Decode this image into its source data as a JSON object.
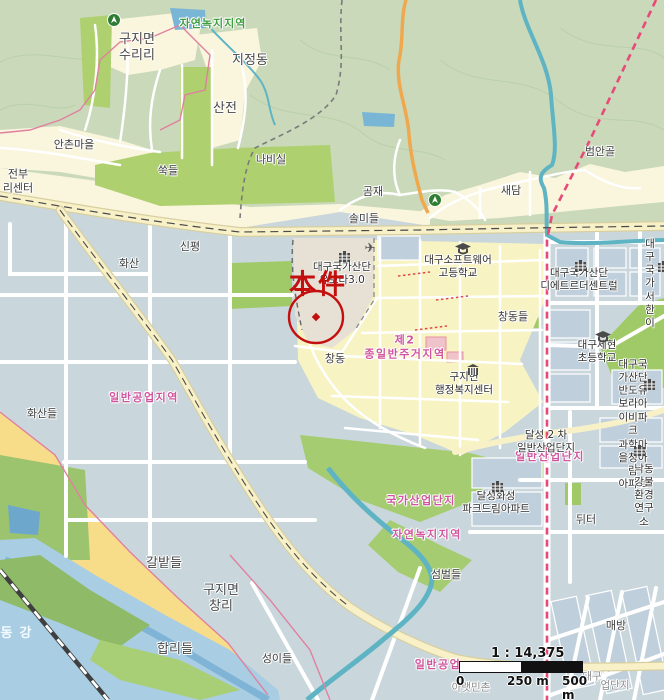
{
  "map": {
    "annotation": {
      "text": "本件",
      "x": 318,
      "y": 282,
      "color": "#c40f0f"
    },
    "scale": {
      "ratio": "1 : 14,375",
      "start": "0",
      "mid": "250 m",
      "end": "500 m"
    },
    "colors": {
      "forest": "#c9d9b9",
      "field-green": "#aed06e",
      "village-cream": "#faf5dd",
      "industrial-gray": "#c9d7dc",
      "residential-yellow": "#f7f3c2",
      "farm-yellow": "#f7dc8a",
      "subject-tan": "#e7e0d4",
      "water": "#a9cde3",
      "stream": "#5fb4c4",
      "major-road": "#f8f1c8",
      "orange-road": "#f0a84e",
      "boundary-red": "#e84a78",
      "zone-label-pink": "#d0559e",
      "annotation-red": "#c40f0f"
    },
    "labels": [
      {
        "text": "구지면\n수리리",
        "x": 137,
        "y": 48,
        "cls": "place-lg"
      },
      {
        "text": "자연녹지지역",
        "x": 213,
        "y": 24,
        "cls": "zone-green"
      },
      {
        "text": "지정동",
        "x": 250,
        "y": 61,
        "cls": "place-lg"
      },
      {
        "text": "산전",
        "x": 225,
        "y": 109,
        "cls": "place-lg"
      },
      {
        "text": "안촌마을",
        "x": 74,
        "y": 145,
        "cls": "place"
      },
      {
        "text": "쑥들",
        "x": 168,
        "y": 171,
        "cls": "place"
      },
      {
        "text": "나비실",
        "x": 271,
        "y": 160,
        "cls": "place"
      },
      {
        "text": "곰재",
        "x": 373,
        "y": 192,
        "cls": "place"
      },
      {
        "text": "솔미들",
        "x": 364,
        "y": 219,
        "cls": "place"
      },
      {
        "text": "새담",
        "x": 511,
        "y": 191,
        "cls": "place"
      },
      {
        "text": "범안골",
        "x": 600,
        "y": 152,
        "cls": "place"
      },
      {
        "text": "전부\n리센터",
        "x": 18,
        "y": 181,
        "cls": "place"
      },
      {
        "text": "신평",
        "x": 190,
        "y": 247,
        "cls": "place"
      },
      {
        "text": "화산",
        "x": 129,
        "y": 264,
        "cls": "place"
      },
      {
        "text": "화산들",
        "x": 42,
        "y": 414,
        "cls": "place"
      },
      {
        "text": "일반공업지역",
        "x": 144,
        "y": 398,
        "cls": "zone-pink"
      },
      {
        "text": "갈밭들",
        "x": 164,
        "y": 564,
        "cls": "place-lg"
      },
      {
        "text": "구지면\n창리",
        "x": 221,
        "y": 599,
        "cls": "place-lg"
      },
      {
        "text": "합리들",
        "x": 175,
        "y": 650,
        "cls": "place-lg"
      },
      {
        "text": "낙동강",
        "x": 10,
        "y": 634,
        "cls": "white-river"
      },
      {
        "text": "성이들",
        "x": 277,
        "y": 659,
        "cls": "place"
      },
      {
        "text": "매방",
        "x": 616,
        "y": 626,
        "cls": "place"
      },
      {
        "text": "뒤터",
        "x": 586,
        "y": 520,
        "cls": "place"
      },
      {
        "text": "섬벌들",
        "x": 446,
        "y": 575,
        "cls": "place"
      },
      {
        "text": "창동",
        "x": 335,
        "y": 359,
        "cls": "place"
      },
      {
        "text": "창동들",
        "x": 513,
        "y": 317,
        "cls": "place"
      },
      {
        "text": "일반공업",
        "x": 438,
        "y": 665,
        "cls": "zone-pink"
      },
      {
        "text": "국가산업단지",
        "x": 421,
        "y": 501,
        "cls": "zone-pink"
      },
      {
        "text": "자연녹지지역",
        "x": 427,
        "y": 535,
        "cls": "zone-pink"
      },
      {
        "text": "일반산업단지",
        "x": 550,
        "y": 457,
        "cls": "zone-pink"
      },
      {
        "text": "제2\n종일반주거지역",
        "x": 405,
        "y": 347,
        "cls": "zone-pink"
      },
      {
        "text": "대구국가산단\n유보라3.0",
        "x": 342,
        "y": 274,
        "cls": "poi"
      },
      {
        "text": "대구소프트웨어\n고등학교",
        "x": 458,
        "y": 267,
        "cls": "poi"
      },
      {
        "text": "대구국가산단\n디에트르더센트럴",
        "x": 579,
        "y": 280,
        "cls": "poi"
      },
      {
        "text": "대구국가\n서한이",
        "x": 650,
        "y": 284,
        "cls": "poi"
      },
      {
        "text": "대구세현\n초등학교",
        "x": 597,
        "y": 352,
        "cls": "poi"
      },
      {
        "text": "구지면\n행정복지센터",
        "x": 464,
        "y": 384,
        "cls": "poi"
      },
      {
        "text": "대구국가산단\n반도유보라아이비파크",
        "x": 633,
        "y": 398,
        "cls": "poi"
      },
      {
        "text": "달성 2 차\n일반산업단지",
        "x": 546,
        "y": 442,
        "cls": "poi"
      },
      {
        "text": "과학마을청아람\n아파트",
        "x": 633,
        "y": 465,
        "cls": "poi"
      },
      {
        "text": "달성화성\n파크드림아파트",
        "x": 496,
        "y": 503,
        "cls": "poi"
      },
      {
        "text": "낙동강물\n환경연구소",
        "x": 644,
        "y": 496,
        "cls": "poi"
      },
      {
        "text": "아랫민촌",
        "x": 471,
        "y": 688,
        "cls": "gray"
      },
      {
        "text": "대구",
        "x": 592,
        "y": 677,
        "cls": "gray"
      },
      {
        "text": "업단지",
        "x": 615,
        "y": 686,
        "cls": "gray"
      }
    ],
    "icons": [
      {
        "type": "trail-marker-icon",
        "x": 107,
        "y": 13
      },
      {
        "type": "trail-marker-icon",
        "x": 428,
        "y": 193
      },
      {
        "type": "school-icon",
        "x": 455,
        "y": 243
      },
      {
        "type": "school-icon",
        "x": 595,
        "y": 331
      },
      {
        "type": "apartment-icon",
        "x": 338,
        "y": 251
      },
      {
        "type": "apartment-icon",
        "x": 574,
        "y": 260
      },
      {
        "type": "apartment-icon",
        "x": 657,
        "y": 261
      },
      {
        "type": "apartment-icon",
        "x": 643,
        "y": 379
      },
      {
        "type": "apartment-icon",
        "x": 633,
        "y": 445
      },
      {
        "type": "apartment-icon",
        "x": 491,
        "y": 481
      },
      {
        "type": "gov-office-icon",
        "x": 466,
        "y": 364
      },
      {
        "type": "airplane-icon",
        "x": 370,
        "y": 248
      }
    ]
  }
}
